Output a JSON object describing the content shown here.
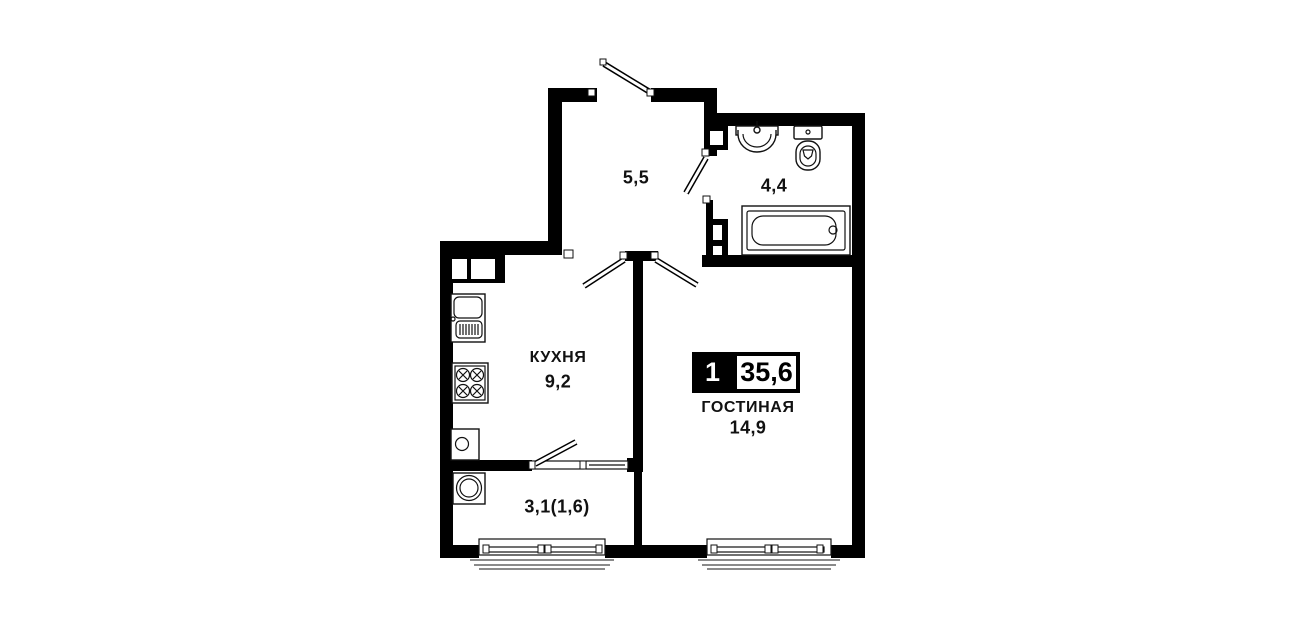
{
  "plan": {
    "type": "apartment-floor-plan",
    "colors": {
      "wall": "#000000",
      "background": "#ffffff",
      "text": "#111111"
    },
    "badge": {
      "room_count": "1",
      "total_area": "35,6"
    },
    "rooms": {
      "hallway": {
        "area": "5,5"
      },
      "bathroom": {
        "area": "4,4"
      },
      "kitchen": {
        "name": "КУХНЯ",
        "area": "9,2"
      },
      "living": {
        "name": "ГОСТИНАЯ",
        "area": "14,9"
      },
      "balcony": {
        "area": "3,1(1,6)"
      }
    },
    "fixtures": [
      "bathroom-sink",
      "toilet",
      "bathtub",
      "vent-shaft",
      "duct-niche",
      "kitchen-sink",
      "stove",
      "water-heater",
      "washing-machine"
    ],
    "openings": [
      "entrance-door",
      "bathroom-door",
      "kitchen-door",
      "living-room-door",
      "balcony-door",
      "balcony-window",
      "kitchen-bottom-window",
      "living-room-bottom-window"
    ]
  }
}
